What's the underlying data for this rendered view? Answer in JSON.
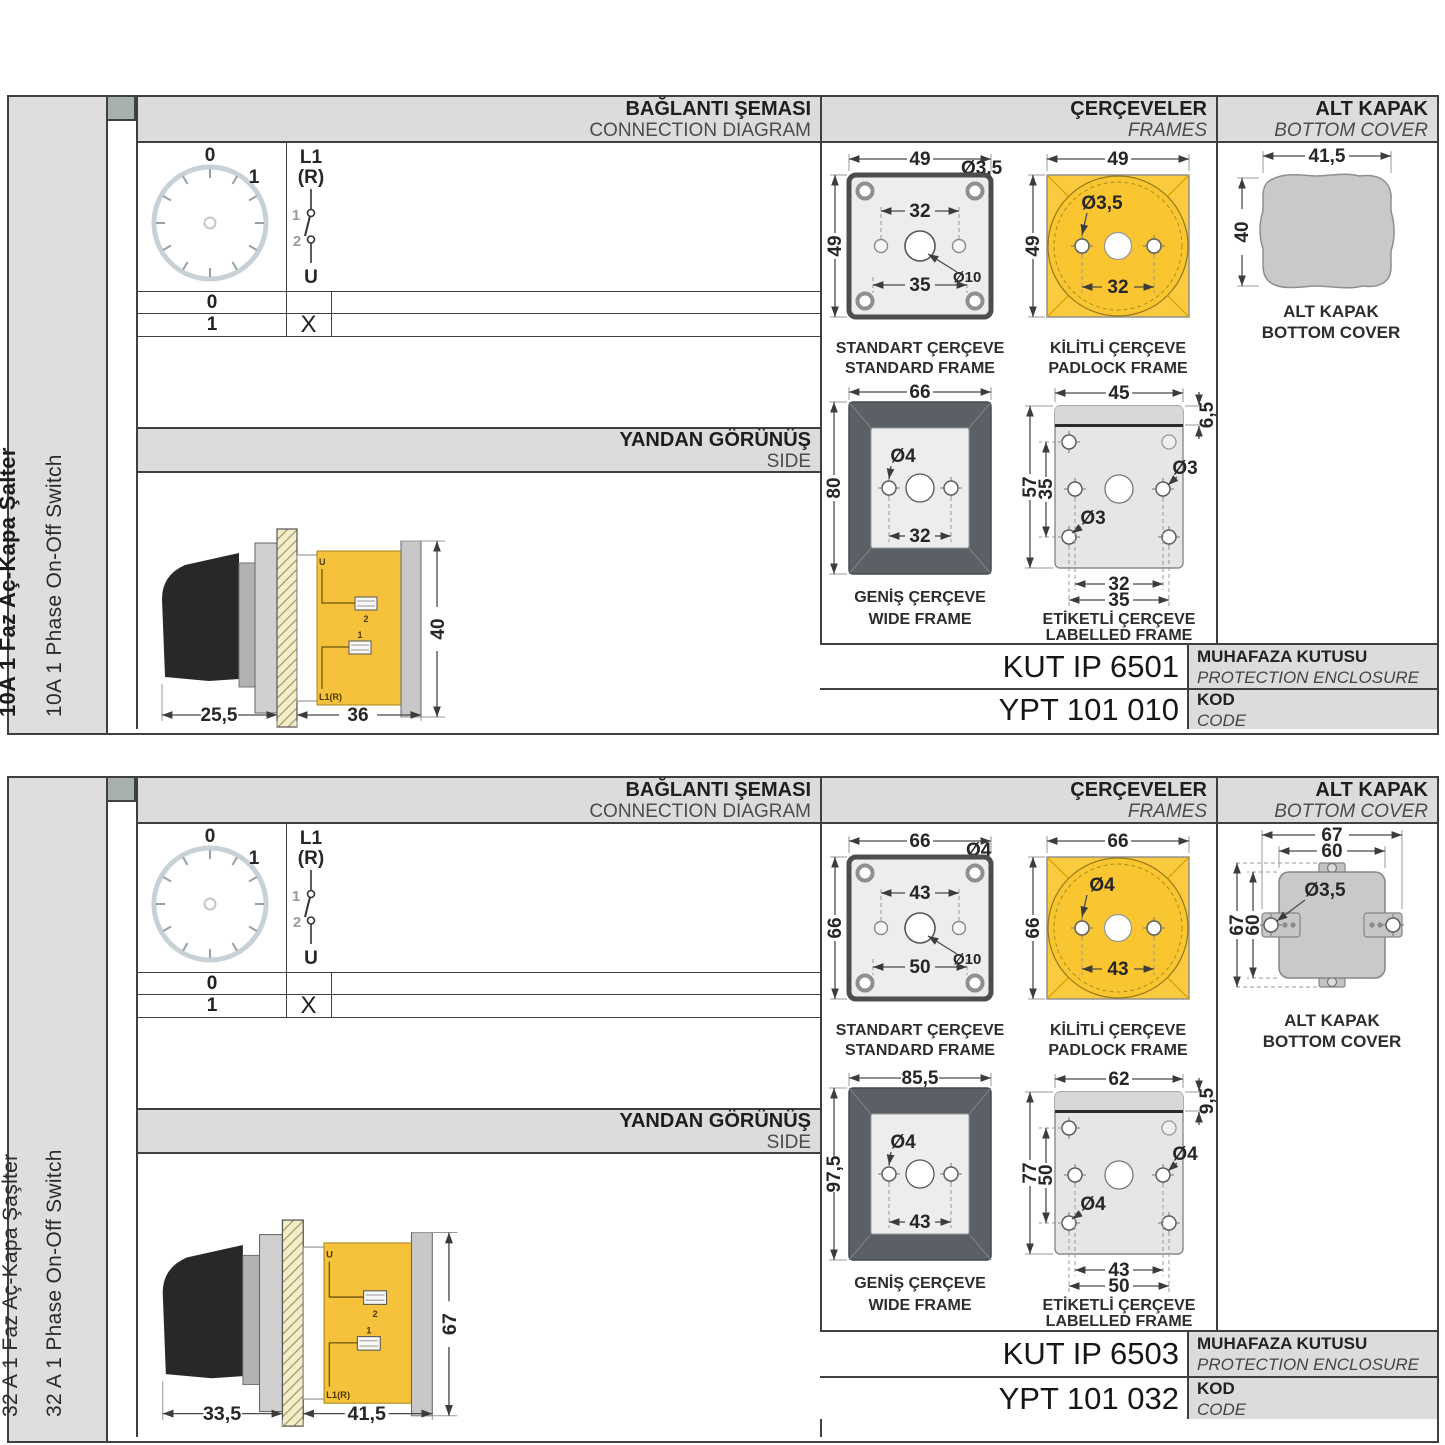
{
  "colors": {
    "header_bg": "#dcdcdc",
    "strip_bg": "#dedede",
    "border": "#3f3f3f",
    "yellow": "#f9c636",
    "dark_frame": "#5a6066",
    "cover_gray": "#c9c9c9"
  },
  "panels": [
    {
      "side_label_tr": "10A 1 Faz Aç-Kapa Şalter",
      "side_label_en": "10A 1 Phase On-Off Switch",
      "connection": {
        "title_tr": "BAĞLANTI ŞEMASI",
        "title_en": "CONNECTION DIAGRAM",
        "dial_positions": [
          "0",
          "1"
        ],
        "switch_labels": {
          "line_in": "L1",
          "line_in2": "(R)",
          "contact_top": "1",
          "contact_bottom": "2",
          "line_out": "U"
        },
        "table": [
          {
            "position": "0",
            "contact": ""
          },
          {
            "position": "1",
            "contact": "X"
          }
        ]
      },
      "side_view": {
        "title_tr": "YANDAN GÖRÜNÜŞ",
        "title_en": "SIDE",
        "dim_depth_handle": "25,5",
        "dim_depth_body": "36",
        "dim_height": "40",
        "terminals": {
          "u": "U",
          "n2": "2",
          "n1": "1",
          "l1": "L1(R)"
        }
      },
      "frames": {
        "title_tr": "ÇERÇEVELER",
        "title_en": "FRAMES",
        "standard": {
          "caption_tr": "STANDART ÇERÇEVE",
          "caption_en": "STANDARD FRAME",
          "dim_w": "49",
          "dim_h": "49",
          "dim_hole": "Ø3,5",
          "dim_centers": "32",
          "dim_shaft": "Ø10",
          "dim_lower": "35"
        },
        "padlock": {
          "caption_tr": "KİLİTLİ ÇERÇEVE",
          "caption_en": "PADLOCK FRAME",
          "dim_w": "49",
          "dim_h": "49",
          "dim_hole": "Ø3,5",
          "dim_centers": "32"
        },
        "wide": {
          "caption_tr": "GENİŞ ÇERÇEVE",
          "caption_en": "WIDE FRAME",
          "dim_w": "66",
          "dim_h": "80",
          "dim_hole": "Ø4",
          "dim_centers": "32"
        },
        "labelled": {
          "caption_tr": "ETİKETLİ ÇERÇEVE",
          "caption_en": "LABELLED FRAME",
          "dim_w": "45",
          "dim_strip": "6,5",
          "dim_h": "57",
          "dim_inner_h": "35",
          "dim_hole_mid": "Ø3",
          "dim_hole_low": "Ø3",
          "dim_centers": "32",
          "dim_lower": "35"
        }
      },
      "bottom_cover": {
        "title_tr": "ALT KAPAK",
        "title_en": "BOTTOM COVER",
        "caption_tr": "ALT KAPAK",
        "caption_en": "BOTTOM COVER",
        "dim_w": "41,5",
        "dim_h": "40"
      },
      "enclosure": {
        "code": "KUT IP 6501",
        "label_tr": "MUHAFAZA KUTUSU",
        "label_en": "PROTECTION ENCLOSURE"
      },
      "order_code": {
        "code": "YPT 101 010",
        "label_tr": "KOD",
        "label_en": "CODE"
      }
    },
    {
      "side_label_tr": "32 A 1 Faz Aç-Kapa Şaşlter",
      "side_label_en": "32 A 1 Phase On-Off Switch",
      "connection": {
        "title_tr": "BAĞLANTI ŞEMASI",
        "title_en": "CONNECTION DIAGRAM",
        "dial_positions": [
          "0",
          "1"
        ],
        "switch_labels": {
          "line_in": "L1",
          "line_in2": "(R)",
          "contact_top": "1",
          "contact_bottom": "2",
          "line_out": "U"
        },
        "table": [
          {
            "position": "0",
            "contact": ""
          },
          {
            "position": "1",
            "contact": "X"
          }
        ]
      },
      "side_view": {
        "title_tr": "YANDAN GÖRÜNÜŞ",
        "title_en": "SIDE",
        "dim_depth_handle": "33,5",
        "dim_depth_body": "41,5",
        "dim_height": "67",
        "terminals": {
          "u": "U",
          "n2": "2",
          "n1": "1",
          "l1": "L1(R)"
        }
      },
      "frames": {
        "title_tr": "ÇERÇEVELER",
        "title_en": "FRAMES",
        "standard": {
          "caption_tr": "STANDART ÇERÇEVE",
          "caption_en": "STANDARD FRAME",
          "dim_w": "66",
          "dim_h": "66",
          "dim_hole": "Ø4",
          "dim_centers": "43",
          "dim_shaft": "Ø10",
          "dim_lower": "50"
        },
        "padlock": {
          "caption_tr": "KİLİTLİ ÇERÇEVE",
          "caption_en": "PADLOCK FRAME",
          "dim_w": "66",
          "dim_h": "66",
          "dim_hole": "Ø4",
          "dim_centers": "43"
        },
        "wide": {
          "caption_tr": "GENİŞ ÇERÇEVE",
          "caption_en": "WIDE FRAME",
          "dim_w": "85,5",
          "dim_h": "97,5",
          "dim_hole": "Ø4",
          "dim_centers": "43"
        },
        "labelled": {
          "caption_tr": "ETİKETLİ ÇERÇEVE",
          "caption_en": "LABELLED FRAME",
          "dim_w": "62",
          "dim_strip": "9,5",
          "dim_h": "77",
          "dim_inner_h": "50",
          "dim_hole_mid": "Ø4",
          "dim_hole_low": "Ø4",
          "dim_centers": "43",
          "dim_lower": "50"
        }
      },
      "bottom_cover": {
        "title_tr": "ALT KAPAK",
        "title_en": "BOTTOM COVER",
        "caption_tr": "ALT KAPAK",
        "caption_en": "BOTTOM COVER",
        "dim_w_outer": "67",
        "dim_w_inner": "60",
        "dim_h_outer": "67",
        "dim_h_inner": "60",
        "dim_hole": "Ø3,5"
      },
      "enclosure": {
        "code": "KUT IP 6503",
        "label_tr": "MUHAFAZA KUTUSU",
        "label_en": "PROTECTION ENCLOSURE"
      },
      "order_code": {
        "code": "YPT 101 032",
        "label_tr": "KOD",
        "label_en": "CODE"
      }
    }
  ]
}
